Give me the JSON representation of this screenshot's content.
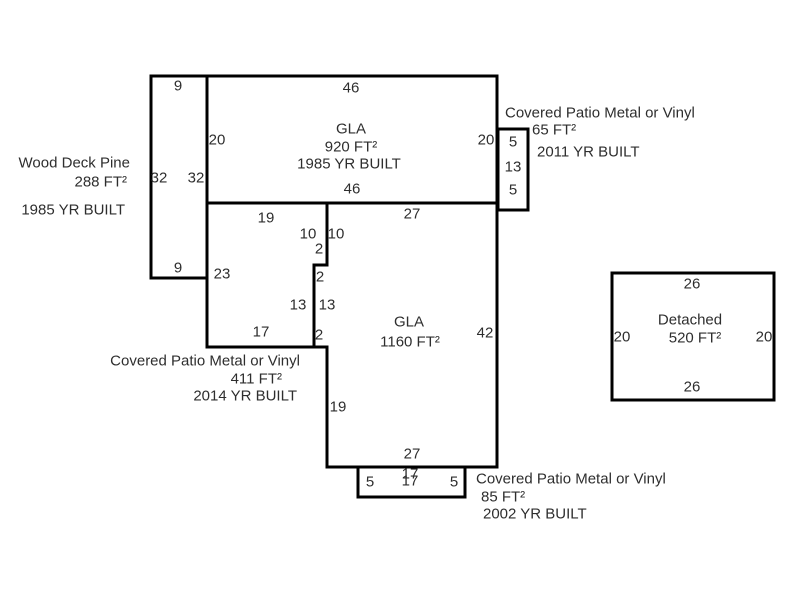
{
  "colors": {
    "wall": "#000000",
    "text": "#2e2e2e",
    "background": "#ffffff"
  },
  "areas": {
    "wood_deck": {
      "name": "Wood Deck Pine",
      "area": "288 FT²",
      "year": "1985 YR BUILT"
    },
    "gla_main": {
      "name": "GLA",
      "area": "920 FT²",
      "year": "1985 YR BUILT"
    },
    "patio_right": {
      "name": "Covered Patio Metal or Vinyl",
      "area": "65 FT²",
      "year": "2011 YR BUILT"
    },
    "patio_left": {
      "name": "Covered Patio Metal or Vinyl",
      "area": "411 FT²",
      "year": "2014 YR BUILT"
    },
    "gla_lower": {
      "name": "GLA",
      "area": "1160 FT²"
    },
    "patio_bottom": {
      "name": "Covered Patio Metal or Vinyl",
      "area": "85 FT²",
      "year": "2002 YR BUILT"
    },
    "detached": {
      "name": "Detached",
      "area": "520 FT²"
    }
  },
  "dims": {
    "deck": {
      "top": "9",
      "left": "32",
      "right": "32",
      "bottom": "9"
    },
    "gla_main": {
      "top": "46",
      "left": "20",
      "right": "20",
      "bottom": "46"
    },
    "patio_right": {
      "top": "5",
      "side": "13",
      "bottom": "5"
    },
    "lower": {
      "top_left": "19",
      "top_right": "27",
      "right": "42",
      "left": "19",
      "bottom": "27"
    },
    "step": {
      "s10_outer": "10",
      "s10_inner": "10",
      "s2_upper": "2",
      "s2_mid": "2",
      "s13_outer": "13",
      "s13_inner": "13",
      "s2_lower": "2"
    },
    "patio_left": {
      "side": "23",
      "bottom": "17"
    },
    "patio_bottom": {
      "left": "5",
      "top_outer": "17",
      "top_inner": "17",
      "right": "5"
    },
    "detached": {
      "top": "26",
      "left": "20",
      "right": "20",
      "bottom": "26"
    }
  }
}
